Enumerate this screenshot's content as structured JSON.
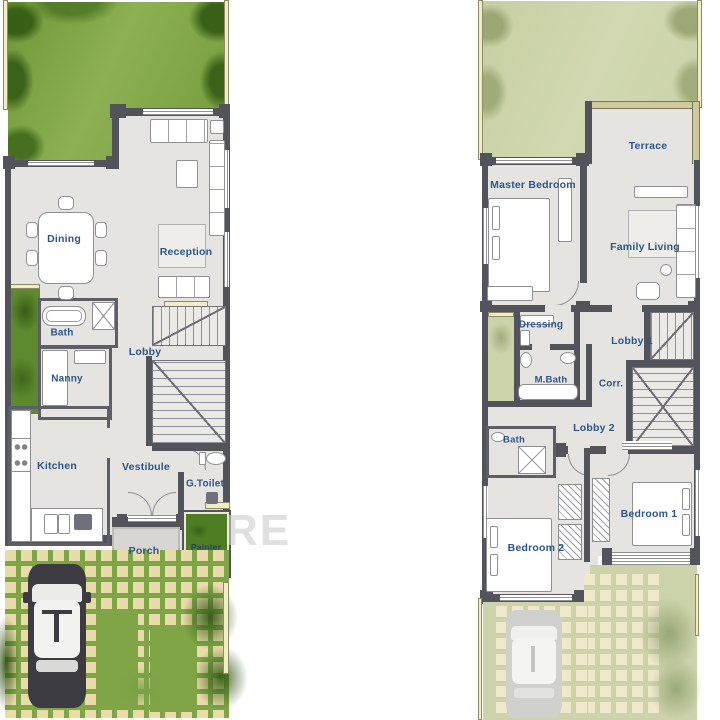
{
  "watermark": {
    "text": "RE"
  },
  "colors": {
    "label_blue": "#2b568b",
    "wall_gray": "#53535b",
    "lawn_green": "#7fa547",
    "faded_green": "#ccd3ab",
    "paver_beige": "#e9dcab",
    "planter_green": "#4e7e24"
  },
  "ground_floor": {
    "rooms": {
      "dining": "Dining",
      "reception": "Reception",
      "bath": "Bath",
      "lobby": "Lobby",
      "nanny": "Nanny",
      "kitchen": "Kitchen",
      "vestibule": "Vestibule",
      "g_toilet": "G.Toilet",
      "porch": "Porch",
      "painter": "Painter"
    }
  },
  "first_floor": {
    "rooms": {
      "terrace": "Terrace",
      "master_bedroom": "Master Bedroom",
      "family_living": "Family Living",
      "dressing": "Dressing",
      "lobby_1": "Lobby 1",
      "m_bath": "M.Bath",
      "corridor": "Corr.",
      "lobby_2": "Lobby 2",
      "bath": "Bath",
      "bedroom_2": "Bedroom 2",
      "bedroom_1": "Bedroom 1"
    }
  }
}
